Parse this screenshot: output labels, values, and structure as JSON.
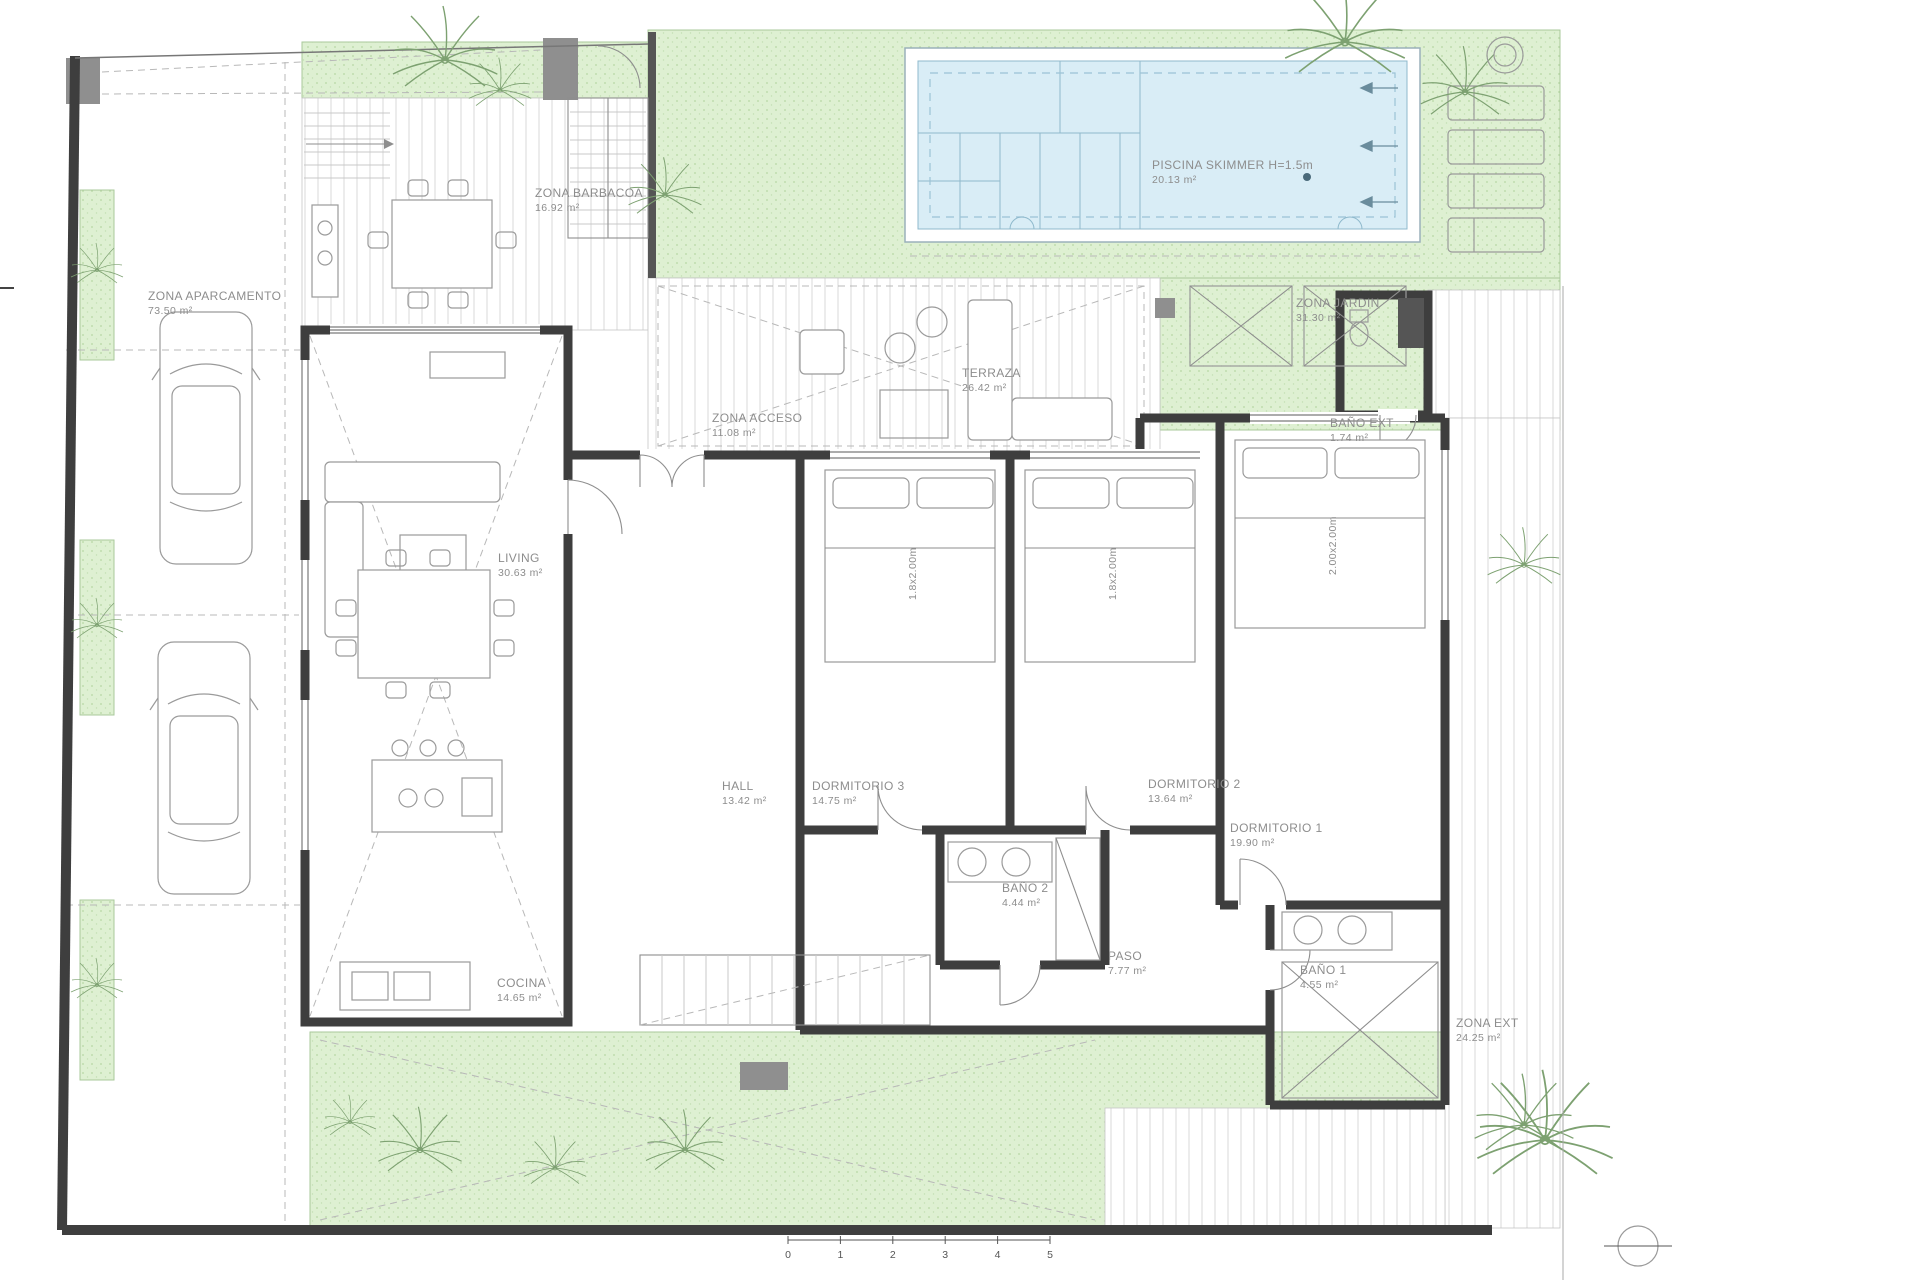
{
  "document": {
    "type": "floor-plan"
  },
  "colors": {
    "wall": "#3e3e3e",
    "garden_green": "#def0d2",
    "pool_water": "#d9edf6",
    "pool_line": "#8fb9cc",
    "deck_line": "#d8d8d8",
    "label_gray": "#8d8d8d",
    "block_gray": "#8f8f8f"
  },
  "rooms": {
    "aparcamento": {
      "name": "ZONA APARCAMENTO",
      "area": "73.50 m²"
    },
    "barbacoa": {
      "name": "ZONA BARBACOA",
      "area": "16.92 m²"
    },
    "piscina": {
      "name": "PISCINA SKIMMER H=1.5m",
      "area": "20.13 m²"
    },
    "jardin": {
      "name": "ZONA JARDIN",
      "area": "31.30 m²"
    },
    "terraza": {
      "name": "TERRAZA",
      "area": "26.42 m²"
    },
    "acceso": {
      "name": "ZONA ACCESO",
      "area": "11.08 m²"
    },
    "living": {
      "name": "LIVING",
      "area": "30.63 m²"
    },
    "bano_ext": {
      "name": "BAÑO EXT",
      "area": "1.74 m²"
    },
    "hall": {
      "name": "HALL",
      "area": "13.42 m²"
    },
    "dormitorio3": {
      "name": "DORMITORIO 3",
      "area": "14.75 m²"
    },
    "dormitorio2": {
      "name": "DORMITORIO 2",
      "area": "13.64 m²"
    },
    "dormitorio1": {
      "name": "DORMITORIO 1",
      "area": "19.90 m²"
    },
    "bano2": {
      "name": "BAÑO 2",
      "area": "4.44 m²"
    },
    "paso": {
      "name": "PASO",
      "area": "7.77 m²"
    },
    "bano1": {
      "name": "BAÑO 1",
      "area": "4.55 m²"
    },
    "cocina": {
      "name": "COCINA",
      "area": "14.65 m²"
    },
    "zona_ext": {
      "name": "ZONA EXT",
      "area": "24.25 m²"
    }
  },
  "beds": {
    "bed_180": "1.8x2.00m",
    "bed_200": "2.00x2.00m"
  },
  "scale_bar": {
    "marks": [
      "0",
      "1",
      "2",
      "3",
      "4",
      "5"
    ]
  }
}
